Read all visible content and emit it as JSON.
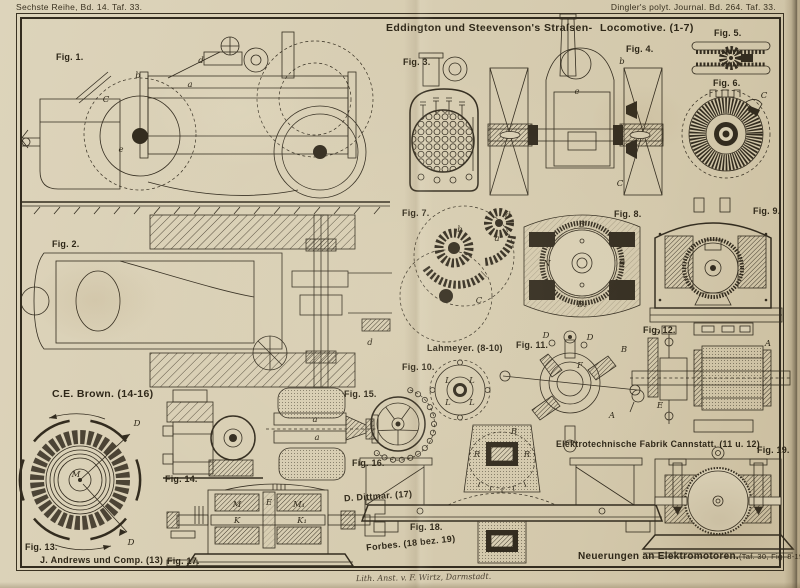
{
  "colors": {
    "paper": "#d8ceb3",
    "ink": "#332c1f"
  },
  "header": {
    "left": "Sechste Reihe, Bd. 14. Taf. 33.",
    "right": "Dingler's polyt. Journal. Bd. 264. Taf. 33."
  },
  "plate": {
    "title_left": "Eddington und Steevenson's Straſsen-",
    "title_right": "Locomotive. (1-7)",
    "bottom_title": "Neuerungen an Elektromotoren.",
    "bottom_title_ref": "(Taf. 30, Fig. 8-19 Taf. 33.)",
    "imprint": "Lith. Anst. v. F. Wirtz, Darmstadt."
  },
  "captions": {
    "brown": "C.E. Brown. (14-16)",
    "lahmeyer": "Lahmeyer. (8-10)",
    "andrews": "J. Andrews und Comp. (13)",
    "dittmar": "D. Dittmar. (17)",
    "forbes": "Forbes. (18 bez. 19)",
    "cannstatt": "Elektrotechnische Fabrik Cannstatt. (11 u. 12)"
  },
  "figures": [
    {
      "label": "Fig. 1.",
      "parts": [
        "a",
        "b",
        "C",
        "d",
        "e"
      ]
    },
    {
      "label": "Fig. 2.",
      "parts": [
        "d"
      ]
    },
    {
      "label": "Fig. 3.",
      "parts": []
    },
    {
      "label": "Fig. 4.",
      "parts": [
        "b",
        "e",
        "C"
      ]
    },
    {
      "label": "Fig. 5.",
      "parts": []
    },
    {
      "label": "Fig. 6.",
      "parts": [
        "C"
      ]
    },
    {
      "label": "Fig. 7.",
      "parts": [
        "a",
        "b",
        "d",
        "C"
      ]
    },
    {
      "label": "Fig. 8.",
      "parts": [
        "B",
        "N",
        "S",
        "B₁"
      ]
    },
    {
      "label": "Fig. 9.",
      "parts": []
    },
    {
      "label": "Fig. 10.",
      "parts": [
        "L",
        "L",
        "L",
        "L"
      ]
    },
    {
      "label": "Fig. 11.",
      "parts": [
        "D",
        "D",
        "B",
        "B",
        "F",
        "A"
      ]
    },
    {
      "label": "Fig. 12.",
      "parts": [
        "D",
        "E",
        "A"
      ]
    },
    {
      "label": "Fig. 13.",
      "parts": [
        "D",
        "D",
        "M"
      ]
    },
    {
      "label": "Fig. 14.",
      "parts": []
    },
    {
      "label": "Fig. 15.",
      "parts": [
        "a",
        "a"
      ]
    },
    {
      "label": "Fig. 16.",
      "parts": []
    },
    {
      "label": "Fig. 17.",
      "parts": [
        "M",
        "E",
        "M₁",
        "K",
        "K₁"
      ]
    },
    {
      "label": "Fig. 18.",
      "parts": [
        "R",
        "R"
      ]
    },
    {
      "label": "Fig. 19.",
      "parts": []
    }
  ]
}
